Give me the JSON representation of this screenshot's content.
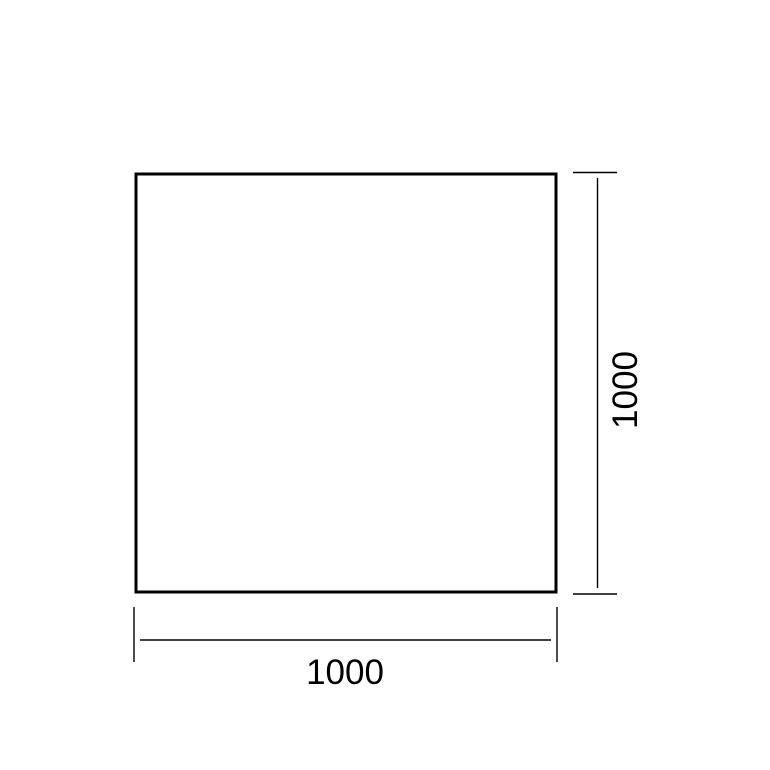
{
  "canvas": {
    "background": "#ffffff",
    "line_color": "#000000",
    "text_color": "#000000"
  },
  "drawing": {
    "shape_fill": "#ffffff"
  },
  "dimensions": {
    "horizontal": {
      "value": "1000"
    },
    "vertical": {
      "value": "1000"
    }
  }
}
